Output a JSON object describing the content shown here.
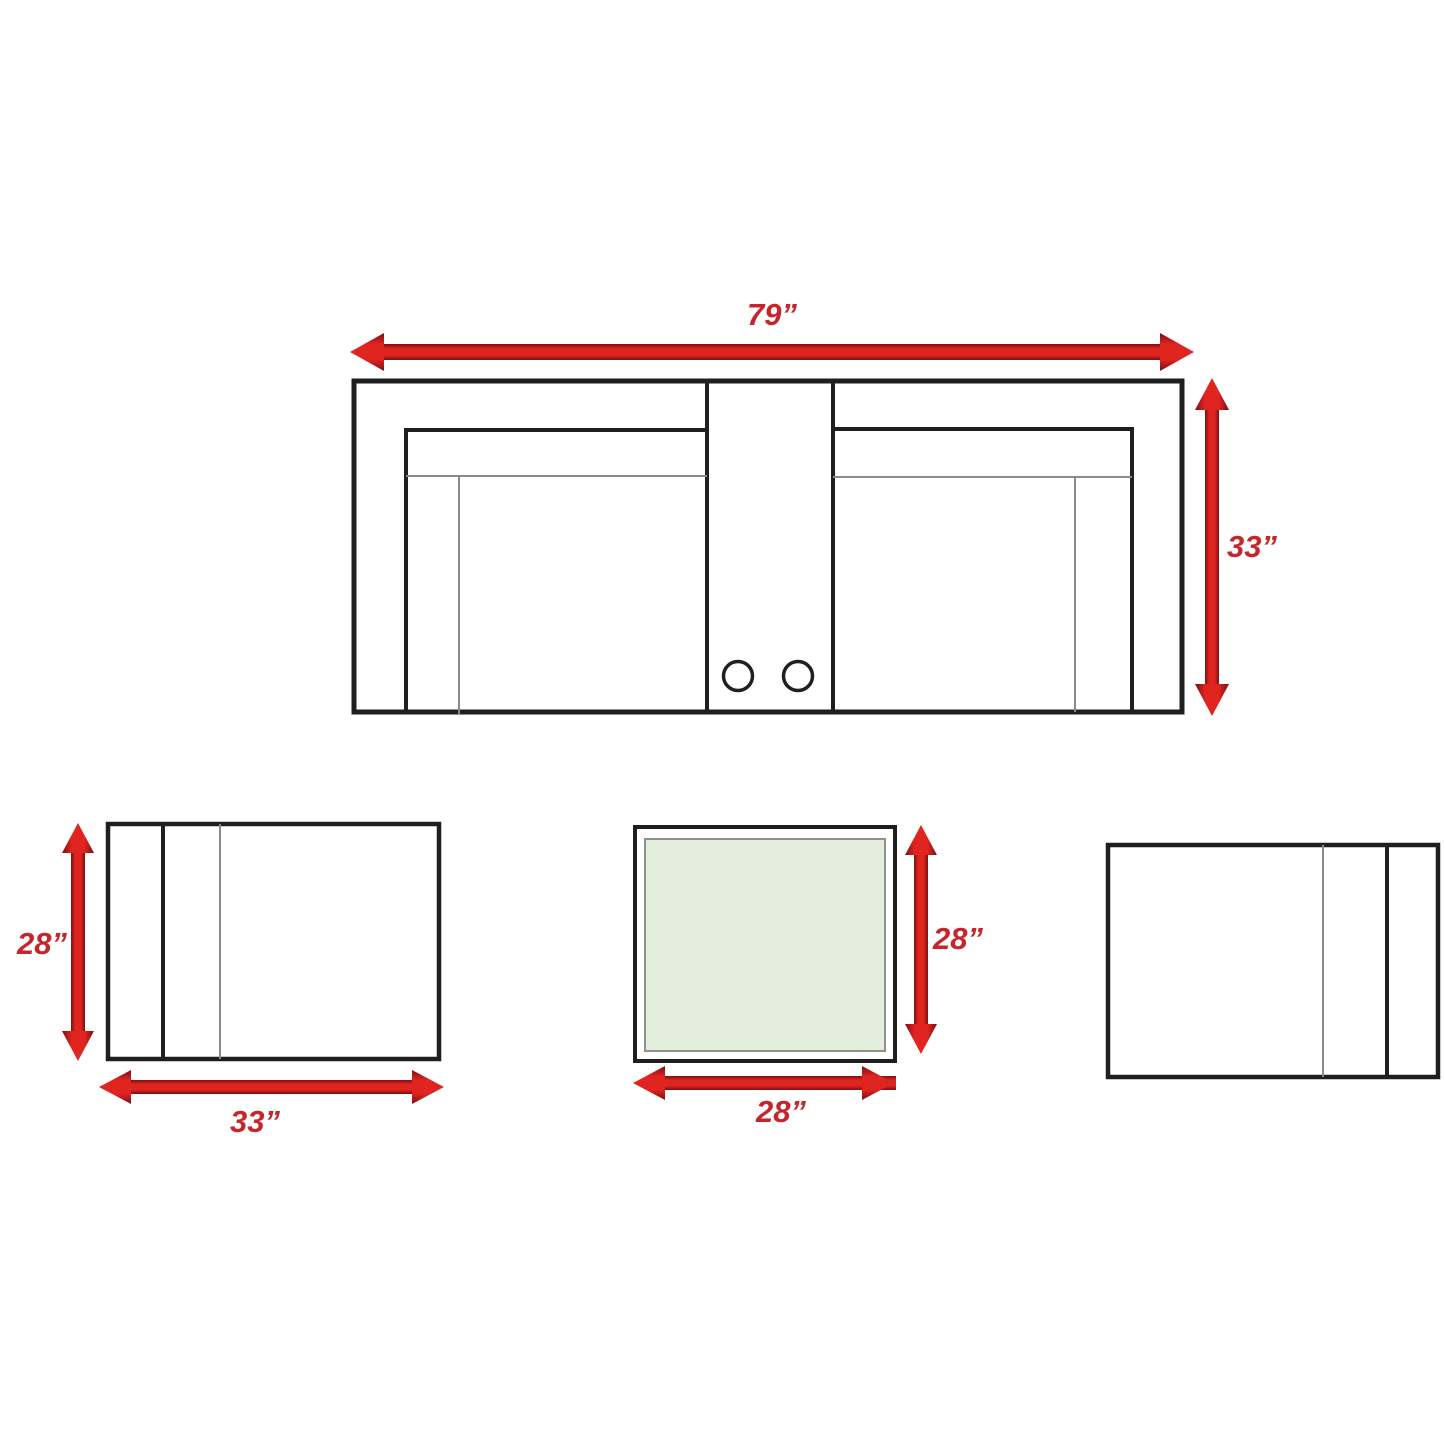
{
  "diagram": {
    "type": "furniture-dimensions-top-view",
    "labels": {
      "sofa_width": "79”",
      "sofa_height": "33”",
      "chair_height": "28”",
      "chair_width": "33”",
      "table_height": "28”",
      "table_width": "28”"
    },
    "pieces": [
      {
        "name": "sofa-with-console",
        "width_in": 79,
        "depth_in": 33
      },
      {
        "name": "armchair-left",
        "width_in": 33,
        "depth_in": 28
      },
      {
        "name": "end-table",
        "width_in": 28,
        "depth_in": 28
      },
      {
        "name": "armchair-right"
      }
    ]
  },
  "colors": {
    "arrow_red": "#e02420",
    "arrow_dark": "#7d0f12",
    "label_red": "#c5262b",
    "outline": "#1f1f1f",
    "thin_line": "#8a8a8a",
    "table_fill": "#e4eedd",
    "table_inner_border": "#909090",
    "background": "#ffffff"
  }
}
